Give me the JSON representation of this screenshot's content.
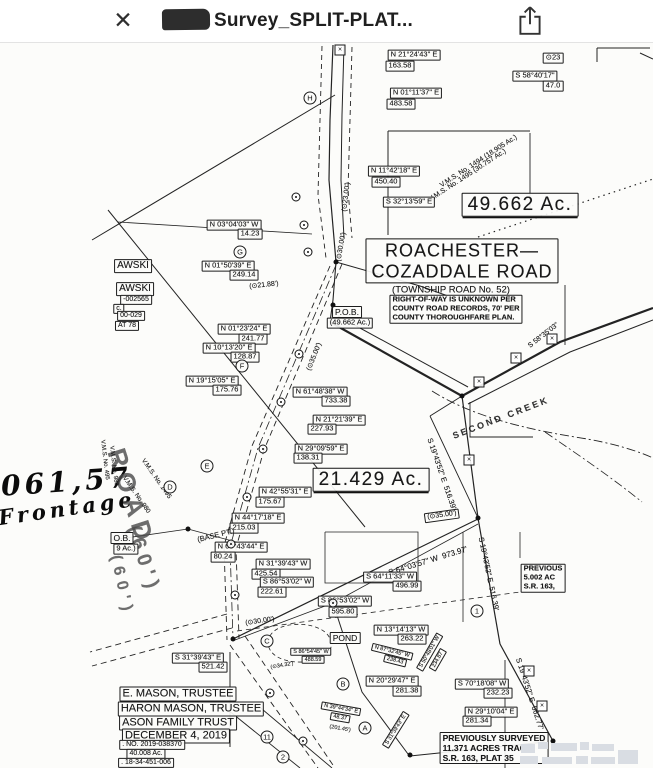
{
  "header": {
    "title": "Survey_SPLIT-PLAT...",
    "close_glyph": "✕"
  },
  "map": {
    "labels": [
      {
        "t": "N 21°24'43\" E",
        "x": 414,
        "y": 55
      },
      {
        "t": "163.58",
        "x": 400,
        "y": 66
      },
      {
        "t": "⊙23",
        "x": 553,
        "y": 58
      },
      {
        "t": "S 58°40'17\"",
        "x": 535,
        "y": 76
      },
      {
        "t": "47.0",
        "x": 553,
        "y": 86
      },
      {
        "t": "N 01°11'37\" E",
        "x": 416,
        "y": 93
      },
      {
        "t": "483.58",
        "x": 401,
        "y": 104
      },
      {
        "t": "N 11°42'18\" E",
        "x": 394,
        "y": 171
      },
      {
        "t": "450.40",
        "x": 386,
        "y": 182
      },
      {
        "t": "V.M.S. No. 1494 (18.905 Ac.)",
        "x": 479,
        "y": 162,
        "r": -33,
        "s": 7,
        "c": "n"
      },
      {
        "t": "V.M.S. No. 1495 (30.757 Ac.)",
        "x": 468,
        "y": 176,
        "r": -33,
        "s": 7,
        "c": "n"
      },
      {
        "t": "49.662 Ac.",
        "x": 520,
        "y": 205,
        "c": "g"
      },
      {
        "t": "S 32°13'59\" E",
        "x": 409,
        "y": 202
      },
      {
        "t": "(⊙23.00')",
        "x": 347,
        "y": 197,
        "r": -83,
        "s": 7,
        "c": "n"
      },
      {
        "t": "(⊙30.00')",
        "x": 342,
        "y": 247,
        "r": -80,
        "s": 7,
        "c": "n"
      },
      {
        "t": "ROACHESTER—\nCOZADDALE ROAD",
        "x": 462,
        "y": 261,
        "c": "g2"
      },
      {
        "t": "(TOWNSHIP ROAD No. 52)",
        "x": 451,
        "y": 290,
        "s": 9.5,
        "c": "n"
      },
      {
        "t": "RIGHT-OF-WAY IS UNKNOWN PER\nCOUNTY ROAD RECORDS, 70' PER\nCOUNTY THOROUGHFARE PLAN.",
        "x": 456,
        "y": 309,
        "s": 7.5,
        "c": "note"
      },
      {
        "t": "P.O.B.",
        "x": 347,
        "y": 312,
        "s": 8.5
      },
      {
        "t": "(49.662 Ac.)",
        "x": 350,
        "y": 323,
        "s": 7.5
      },
      {
        "t": "N 03°04'03\" W",
        "x": 234,
        "y": 225
      },
      {
        "t": "14.23",
        "x": 250,
        "y": 234
      },
      {
        "t": "N 01°50'39\" E",
        "x": 228,
        "y": 266
      },
      {
        "t": "249.14",
        "x": 244,
        "y": 275
      },
      {
        "t": "(⊙21.88')",
        "x": 264,
        "y": 286,
        "r": -6,
        "s": 7,
        "c": "n"
      },
      {
        "t": "N 01°23'24\" E",
        "x": 244,
        "y": 329
      },
      {
        "t": "241.77",
        "x": 253,
        "y": 339
      },
      {
        "t": "N 10°13'20\" E",
        "x": 229,
        "y": 348
      },
      {
        "t": "128.87",
        "x": 245,
        "y": 357
      },
      {
        "t": "N 19°15'05\" E",
        "x": 212,
        "y": 381
      },
      {
        "t": "175.76",
        "x": 227,
        "y": 390
      },
      {
        "t": "(⊙35.00')",
        "x": 315,
        "y": 357,
        "r": -68,
        "s": 7,
        "c": "n"
      },
      {
        "t": "N 61°48'38\" W",
        "x": 320,
        "y": 392
      },
      {
        "t": "733.38",
        "x": 336,
        "y": 401
      },
      {
        "t": "N 21°21'39\" E",
        "x": 339,
        "y": 420
      },
      {
        "t": "227.93",
        "x": 322,
        "y": 429
      },
      {
        "t": "N 29°09'59\" E",
        "x": 321,
        "y": 449
      },
      {
        "t": "138.31",
        "x": 308,
        "y": 458
      },
      {
        "t": "21.429 Ac.",
        "x": 371,
        "y": 480,
        "c": "g"
      },
      {
        "t": "N 42°55'31\" E",
        "x": 285,
        "y": 492
      },
      {
        "t": "175.67",
        "x": 270,
        "y": 502
      },
      {
        "t": "N 44°17'18\" E",
        "x": 258,
        "y": 518
      },
      {
        "t": "215.03",
        "x": 244,
        "y": 528
      },
      {
        "t": "(BASE PT.)",
        "x": 216,
        "y": 536,
        "r": -14,
        "s": 7.5,
        "c": "n"
      },
      {
        "t": "N 60°43'44\" E",
        "x": 241,
        "y": 547
      },
      {
        "t": "80.24",
        "x": 223,
        "y": 557
      },
      {
        "t": "N 31°39'43\" W",
        "x": 283,
        "y": 564
      },
      {
        "t": "425.54",
        "x": 266,
        "y": 574
      },
      {
        "t": "S 86°53'02\" W",
        "x": 287,
        "y": 582
      },
      {
        "t": "222.61",
        "x": 272,
        "y": 592
      },
      {
        "t": "S 64°03'57\" W  973.97'",
        "x": 428,
        "y": 561,
        "r": -17,
        "s": 8,
        "c": "n"
      },
      {
        "t": "S 64°11'33\" W",
        "x": 390,
        "y": 577
      },
      {
        "t": "496.99",
        "x": 407,
        "y": 586
      },
      {
        "t": "S 86°53'02\" W",
        "x": 345,
        "y": 601
      },
      {
        "t": "595.80",
        "x": 343,
        "y": 612
      },
      {
        "t": "(⊙30.00')",
        "x": 260,
        "y": 622,
        "r": -8,
        "s": 7,
        "c": "n"
      },
      {
        "t": "S 31°39'43\" E",
        "x": 198,
        "y": 658
      },
      {
        "t": "521.42",
        "x": 213,
        "y": 667
      },
      {
        "t": "S 86°54'45\" W",
        "x": 311,
        "y": 652,
        "s": 5.5
      },
      {
        "t": "488.59",
        "x": 313,
        "y": 660,
        "s": 5.5
      },
      {
        "t": "(⊙34.32')",
        "x": 282,
        "y": 666,
        "r": -10,
        "s": 5.5,
        "c": "n"
      },
      {
        "t": "POND",
        "x": 345,
        "y": 638,
        "s": 8.5
      },
      {
        "t": "N 13°14'13\" W",
        "x": 401,
        "y": 630
      },
      {
        "t": "263.22",
        "x": 412,
        "y": 639
      },
      {
        "t": "N 87°32'45\" W",
        "x": 392,
        "y": 652,
        "r": 14,
        "s": 5.5
      },
      {
        "t": "238.43",
        "x": 395,
        "y": 661,
        "r": 14,
        "s": 5.5
      },
      {
        "t": "S 50°48'01\" W",
        "x": 430,
        "y": 652,
        "r": -60,
        "s": 5.5
      },
      {
        "t": "234.87",
        "x": 438,
        "y": 660,
        "r": -60,
        "s": 5.5
      },
      {
        "t": "N 20°29'47\" E",
        "x": 392,
        "y": 681
      },
      {
        "t": "281.38",
        "x": 407,
        "y": 691
      },
      {
        "t": "S 70°18'08\" W",
        "x": 482,
        "y": 684
      },
      {
        "t": "232.23",
        "x": 498,
        "y": 693
      },
      {
        "t": "N 29°10'04\" E",
        "x": 491,
        "y": 712
      },
      {
        "t": "281.34",
        "x": 477,
        "y": 721
      },
      {
        "t": "PREVIOUSLY SURVEYED\n11.371 ACRES TRACT\nS.R. 163, PLAT 35",
        "x": 494,
        "y": 748,
        "s": 8.5,
        "c": "note"
      },
      {
        "t": "PREVIOUS\n5.002 AC\nS.R. 163,",
        "x": 543,
        "y": 578,
        "s": 7.5,
        "c": "note"
      },
      {
        "t": "S 19°43'52\" E  516.39'",
        "x": 441,
        "y": 474,
        "r": 71,
        "s": 7.5,
        "c": "n"
      },
      {
        "t": "S 19°43'52\" E  516.39'",
        "x": 488,
        "y": 574,
        "r": 78,
        "s": 7.5,
        "c": "n"
      },
      {
        "t": "S 19°43'52\" E  662.77'",
        "x": 529,
        "y": 694,
        "r": 72,
        "s": 7.5,
        "c": "n"
      },
      {
        "t": "S 58°35'03\"",
        "x": 544,
        "y": 336,
        "r": -38,
        "s": 7,
        "c": "n"
      },
      {
        "t": "SECOND CREEK",
        "x": 501,
        "y": 418,
        "r": -21,
        "s": 9,
        "c": "n sp"
      },
      {
        "t": "(⊙35.00')",
        "x": 442,
        "y": 516,
        "r": -8,
        "s": 7
      },
      {
        "t": "AWSKI",
        "x": 133,
        "y": 266,
        "s": 10
      },
      {
        "t": "AWSKI",
        "x": 135,
        "y": 289,
        "s": 10
      },
      {
        "t": "-002565",
        "x": 136,
        "y": 300,
        "s": 7
      },
      {
        "t": "c.",
        "x": 119,
        "y": 309,
        "s": 7
      },
      {
        "t": "00-029",
        "x": 131,
        "y": 316,
        "s": 7
      },
      {
        "t": "AT 78",
        "x": 127,
        "y": 326,
        "s": 7
      },
      {
        "t": "1,061,57",
        "x": 48,
        "y": 483,
        "r": -4,
        "s": 28,
        "c": "hw"
      },
      {
        "t": "Frontage",
        "x": 67,
        "y": 509,
        "r": -8,
        "s": 21,
        "c": "hw"
      },
      {
        "t": "ROAD",
        "x": 131,
        "y": 497,
        "r": 72,
        "s": 26,
        "c": "road"
      },
      {
        "t": "(60')",
        "x": 143,
        "y": 560,
        "r": 72,
        "s": 20,
        "c": "road"
      },
      {
        "t": "(60')",
        "x": 121,
        "y": 586,
        "r": 78,
        "s": 16,
        "c": "road"
      },
      {
        "t": "V.M.S. No. 1495",
        "x": 156,
        "y": 479,
        "r": 55,
        "s": 6.5,
        "c": "n"
      },
      {
        "t": "V.M.S. No. 980",
        "x": 136,
        "y": 495,
        "r": 55,
        "s": 6.5,
        "c": "n"
      },
      {
        "t": "V.M.S. No. 495",
        "x": 104,
        "y": 460,
        "r": 83,
        "s": 6,
        "c": "n"
      },
      {
        "t": "V.M.S. No. 980",
        "x": 113,
        "y": 466,
        "r": 83,
        "s": 6,
        "c": "n"
      },
      {
        "t": "O.B.",
        "x": 122,
        "y": 538,
        "s": 8.5
      },
      {
        "t": "9 Ac.)",
        "x": 126,
        "y": 549,
        "s": 7.5
      },
      {
        "t": "E. MASON, TRUSTEE",
        "x": 178,
        "y": 694,
        "s": 11
      },
      {
        "t": "HARON MASON, TRUSTEE",
        "x": 191,
        "y": 709,
        "s": 11
      },
      {
        "t": "ASON FAMILY TRUST",
        "x": 178,
        "y": 723,
        "s": 11
      },
      {
        "t": "DECEMBER 4, 2019",
        "x": 176,
        "y": 736,
        "s": 11
      },
      {
        "t": ". NO. 2019-038370",
        "x": 152,
        "y": 745,
        "s": 7
      },
      {
        "t": "40.008 Ac.",
        "x": 146,
        "y": 754,
        "s": 7
      },
      {
        "t": ". 18-34-451-006",
        "x": 146,
        "y": 763,
        "s": 7
      },
      {
        "t": "N 39°44'34\" E",
        "x": 341,
        "y": 709,
        "r": 10,
        "s": 5.5
      },
      {
        "t": "48.37",
        "x": 340,
        "y": 718,
        "r": 10,
        "s": 5.5
      },
      {
        "t": "(201.45')",
        "x": 340,
        "y": 729,
        "r": 10,
        "s": 5.5,
        "c": "n"
      },
      {
        "t": "S 31°39'43\" E",
        "x": 396,
        "y": 730,
        "r": -58,
        "s": 5.5
      }
    ],
    "circled_marks": [
      {
        "t": "H",
        "x": 310,
        "y": 98
      },
      {
        "t": "G",
        "x": 240,
        "y": 252
      },
      {
        "t": "F",
        "x": 242,
        "y": 366
      },
      {
        "t": "E",
        "x": 207,
        "y": 466
      },
      {
        "t": "D",
        "x": 170,
        "y": 487
      },
      {
        "t": "C",
        "x": 267,
        "y": 641
      },
      {
        "t": "B",
        "x": 343,
        "y": 684
      },
      {
        "t": "A",
        "x": 365,
        "y": 728
      },
      {
        "t": "1",
        "x": 477,
        "y": 611
      },
      {
        "t": "11",
        "x": 267,
        "y": 737
      },
      {
        "t": "2",
        "x": 283,
        "y": 757
      }
    ],
    "x_mark_glyph": "×",
    "x_marks": [
      [
        340,
        50
      ],
      [
        516,
        358
      ],
      [
        479,
        382
      ],
      [
        552,
        339
      ],
      [
        469,
        460
      ],
      [
        529,
        671
      ],
      [
        542,
        706
      ]
    ],
    "dots": [
      [
        188,
        529
      ],
      [
        478,
        518
      ],
      [
        462,
        396
      ],
      [
        553,
        741
      ],
      [
        410,
        755
      ],
      [
        233,
        639
      ],
      [
        336,
        262
      ],
      [
        333,
        305
      ]
    ],
    "rings": [
      [
        299,
        354
      ],
      [
        281,
        402
      ],
      [
        263,
        449
      ],
      [
        247,
        497
      ],
      [
        231,
        544
      ],
      [
        235,
        595
      ],
      [
        270,
        693
      ],
      [
        303,
        741
      ],
      [
        296,
        197
      ],
      [
        304,
        225
      ],
      [
        308,
        252
      ],
      [
        333,
        603
      ]
    ],
    "lines": [
      {
        "d": "M333,45 L330,120 329,180 336,262",
        "w": 1.2
      },
      {
        "d": "M344,45 L342,115 341,180 344,238",
        "w": 1
      },
      {
        "d": "M322,46 L320,120 318,195 326,258",
        "w": 0.9,
        "da": "5,4"
      },
      {
        "d": "M352,47 L350,120 348,190 352,238",
        "w": 0.9,
        "da": "5,4"
      },
      {
        "d": "M336,262 L333,300 330,322",
        "w": 1.1
      },
      {
        "d": "M330,322 L462,396",
        "w": 2.2
      },
      {
        "d": "M338,316 L468,387",
        "w": 1
      },
      {
        "d": "M462,396 L560,342 653,308",
        "w": 2.2
      },
      {
        "d": "M468,404 L570,352 653,320",
        "w": 1
      },
      {
        "d": "M336,262 L420,286 448,296",
        "w": 1
      },
      {
        "d": "M462,396 L478,518 500,644",
        "w": 1.2
      },
      {
        "d": "M500,644 L553,741",
        "w": 1.2
      },
      {
        "d": "M410,756 L545,742",
        "w": 1
      },
      {
        "d": "M478,519 L233,639",
        "w": 1.2
      },
      {
        "d": "M478,524 L333,603",
        "w": 0.8
      },
      {
        "d": "M333,603 L235,640",
        "w": 0.8
      },
      {
        "d": "M333,603 L362,692 408,754",
        "w": 1
      },
      {
        "d": "M108,210 L365,527",
        "w": 1
      },
      {
        "d": "M92,240 L335,95",
        "w": 1
      },
      {
        "d": "M118,222 L312,234",
        "w": 0.8
      },
      {
        "d": "M388,131 L388,235",
        "w": 1
      },
      {
        "d": "M388,131 L530,131",
        "w": 0.9
      },
      {
        "d": "M530,133 L530,208",
        "w": 0.9
      },
      {
        "d": "M565,285 L565,345",
        "w": 0.9
      },
      {
        "d": "M230,652 L230,747",
        "w": 1
      },
      {
        "d": "M188,529 L262,549",
        "w": 0.8
      },
      {
        "d": "M188,529 L112,540",
        "w": 0.8
      },
      {
        "d": "M505,660 L505,768",
        "w": 0.9
      },
      {
        "d": "M228,710 L300,768",
        "w": 0.9
      },
      {
        "d": "M256,704 L332,768",
        "w": 0.9
      },
      {
        "d": "M470,402 L470,437 533,437",
        "w": 0.9
      },
      {
        "d": "M463,532 L463,622",
        "w": 0.8
      },
      {
        "d": "M520,532 L520,558",
        "w": 0.8
      },
      {
        "d": "M325,532 L325,583 418,583 418,532 325,532",
        "w": 0.8
      },
      {
        "d": "M597,48 L650,48 M597,48 L597,62 M640,53 L653,59",
        "w": 1
      },
      {
        "d": "M430,416 L478,518",
        "w": 0.9
      },
      {
        "d": "M462,396 L430,416",
        "w": 1
      },
      {
        "d": "M342,264 L264,450 236,548 239,638",
        "w": 0.9,
        "da": "6,4"
      },
      {
        "d": "M330,266 L252,446 224,546 227,640",
        "w": 0.9,
        "da": "6,4"
      },
      {
        "d": "M336,265 L258,448 230,547 233,639",
        "w": 0.8,
        "da": "9,3,2,3"
      },
      {
        "d": "M245,636 L335,768",
        "w": 0.9,
        "da": "6,4"
      },
      {
        "d": "M230,645 L318,768",
        "w": 0.9,
        "da": "6,4"
      },
      {
        "d": "M227,614 L90,652",
        "w": 0.9,
        "da": "6,4"
      },
      {
        "d": "M232,628 L92,666",
        "w": 0.9,
        "da": "6,4"
      },
      {
        "d": "M237,631 L520,592",
        "w": 0.8,
        "da": "5,4"
      },
      {
        "d": "M432,391 C470,415 520,428 575,437 C615,443 640,452 653,458",
        "w": 0.9,
        "da": "9,3,2,3"
      },
      {
        "d": "M545,432 C580,456 615,480 642,502",
        "w": 0.8,
        "da": "9,3,2,3"
      },
      {
        "d": "M478,237 L656,178",
        "w": 1.2,
        "da": "1.5,4"
      },
      {
        "d": "M270,636 C277,622 312,620 326,633 C338,645 330,660 303,662 C277,663 263,650 270,636",
        "w": 0.8,
        "da": "4,3"
      }
    ],
    "watermark_blocks": [
      [
        521,
        744,
        14,
        9
      ],
      [
        538,
        742,
        10,
        7
      ],
      [
        551,
        743,
        26,
        8
      ],
      [
        580,
        742,
        9,
        8
      ],
      [
        592,
        744,
        22,
        7
      ],
      [
        520,
        756,
        18,
        8
      ],
      [
        542,
        757,
        30,
        7
      ],
      [
        576,
        756,
        12,
        8
      ],
      [
        591,
        757,
        24,
        7
      ],
      [
        618,
        750,
        20,
        14
      ]
    ]
  }
}
